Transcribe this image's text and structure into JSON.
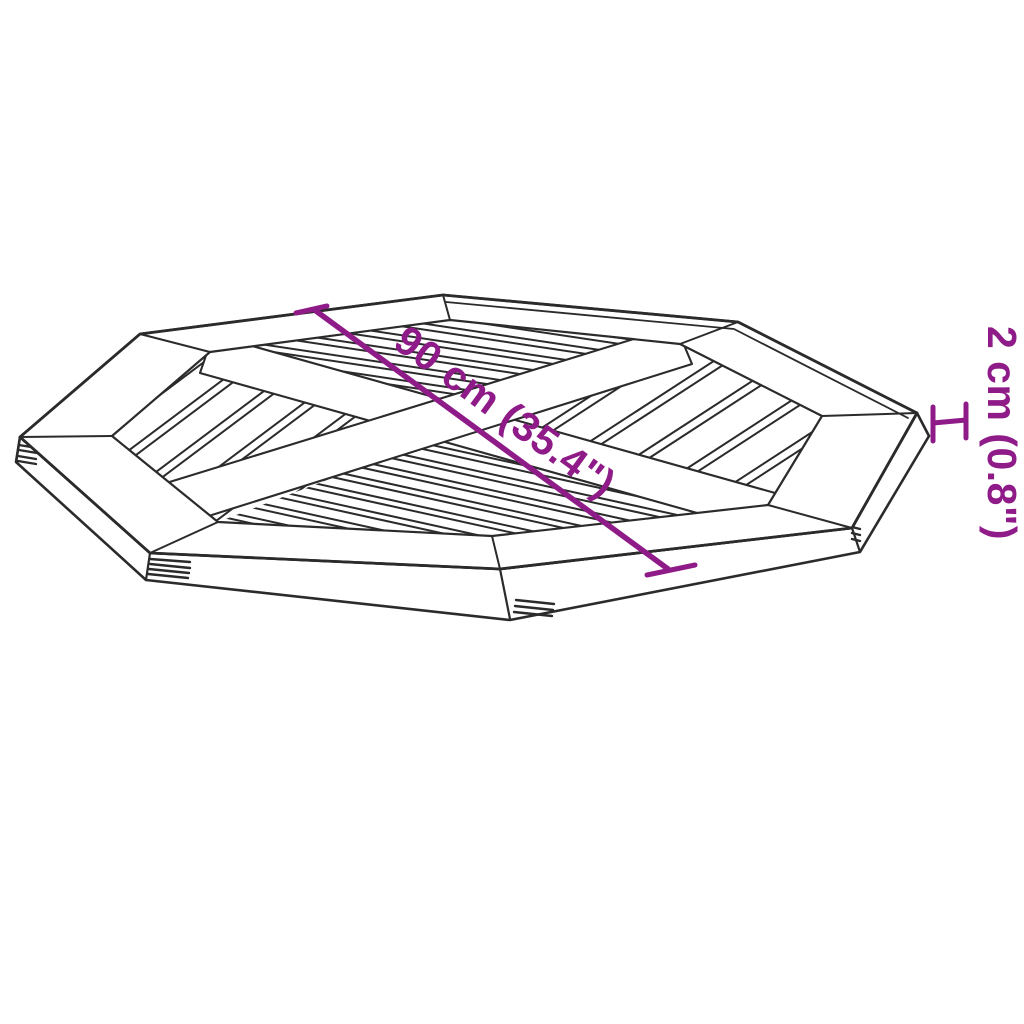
{
  "diagram": {
    "description": "octagonal slatted table top line drawing",
    "dimensions": {
      "diagonal": {
        "label": "90 cm (35.4\")"
      },
      "thickness": {
        "label": "2 cm (0.8\")"
      }
    },
    "icons": {
      "thickness_extent": "h-bracket"
    },
    "colors": {
      "dimension_accent": "#8F1B89",
      "line": "#2b2b2b",
      "background": "#ffffff"
    }
  }
}
